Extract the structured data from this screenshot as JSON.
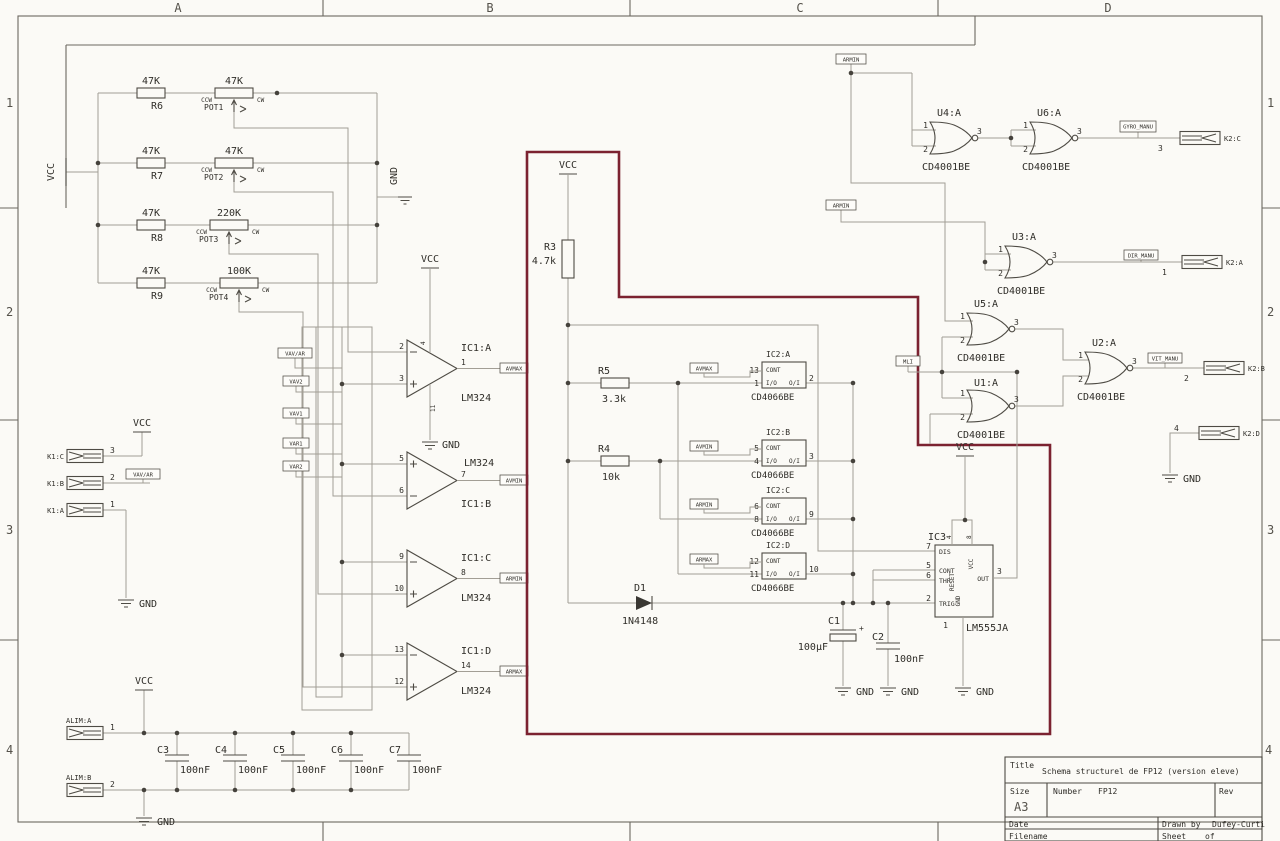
{
  "colors": {
    "highlight": "#7b2230"
  },
  "sheet": {
    "zones": [
      "A",
      "B",
      "C",
      "D"
    ],
    "rows": [
      "1",
      "2",
      "3",
      "4"
    ]
  },
  "common": {
    "vcc": "VCC",
    "gnd": "GND",
    "ccw": "CCW",
    "cw": "CW"
  },
  "resistor_network": {
    "rows": [
      {
        "ref": "R6",
        "value": "47K",
        "pot": "POT1",
        "pot_value": "47K"
      },
      {
        "ref": "R7",
        "value": "47K",
        "pot": "POT2",
        "pot_value": "47K"
      },
      {
        "ref": "R8",
        "value": "47K",
        "pot": "POT3",
        "pot_value": "220K"
      },
      {
        "ref": "R9",
        "value": "47K",
        "pot": "POT4",
        "pot_value": "100K"
      }
    ]
  },
  "input_labels": {
    "l1": "VAV/AR",
    "l2": "VAV2",
    "l3": "VAV1",
    "l4": "VAR1",
    "l5": "VAR2"
  },
  "opamps": [
    {
      "name": "IC1:A",
      "part": "LM324",
      "pin_inv": "2",
      "pin_ni": "3",
      "pin_out": "1",
      "out": "AVMAX",
      "pin_vcc": "4",
      "pin_gnd": "11"
    },
    {
      "name": "IC1:B",
      "part": "LM324",
      "pin_ni": "5",
      "pin_inv": "6",
      "pin_out": "7",
      "out": "AVMIN"
    },
    {
      "name": "IC1:C",
      "part": "LM324",
      "pin_inv": "9",
      "pin_ni": "10",
      "pin_out": "8",
      "out": "ARMIN"
    },
    {
      "name": "IC1:D",
      "part": "LM324",
      "pin_inv": "13",
      "pin_ni": "12",
      "pin_out": "14",
      "out": "ARMAX"
    }
  ],
  "analog_block": {
    "r3": {
      "ref": "R3",
      "value": "4.7k"
    },
    "r5": {
      "ref": "R5",
      "value": "3.3k"
    },
    "r4": {
      "ref": "R4",
      "value": "10k"
    },
    "d1": {
      "ref": "D1",
      "value": "1N4148"
    },
    "port_cont": "CONT",
    "port_io": "I/O",
    "port_oi": "O/I",
    "switches": [
      {
        "name": "IC2:A",
        "part": "CD4066BE",
        "pin_cont": "13",
        "pin_in": "1",
        "pin_out": "2",
        "ctrl": "AVMAX"
      },
      {
        "name": "IC2:B",
        "part": "CD4066BE",
        "pin_cont": "5",
        "pin_in": "4",
        "pin_out": "3",
        "ctrl": "AVMIN"
      },
      {
        "name": "IC2:C",
        "part": "CD4066BE",
        "pin_cont": "6",
        "pin_in": "8",
        "pin_out": "9",
        "ctrl": "ARMIN"
      },
      {
        "name": "IC2:D",
        "part": "CD4066BE",
        "pin_cont": "12",
        "pin_in": "11",
        "pin_out": "10",
        "ctrl": "ARMAX"
      }
    ],
    "c1": {
      "ref": "C1",
      "value": "100µF",
      "polarity": "+"
    },
    "c2": {
      "ref": "C2",
      "value": "100nF"
    },
    "timer": {
      "name": "IC3",
      "part": "LM555JA",
      "dis": "DIS",
      "cont": "CONT",
      "thr": "THR",
      "trig": "TRIG",
      "reset": "RESET",
      "vcc": "VCC",
      "out": "OUT",
      "gnd": "GND",
      "p_dis": "7",
      "p_cont": "5",
      "p_thr": "6",
      "p_trig": "2",
      "p_reset": "4",
      "p_vcc": "8",
      "p_out": "3",
      "p_gnd": "1"
    }
  },
  "gates": {
    "u4": {
      "name": "U4:A",
      "part": "CD4001BE",
      "p1": "1",
      "p2": "2",
      "p3": "3"
    },
    "u6": {
      "name": "U6:A",
      "part": "CD4001BE",
      "p1": "1",
      "p2": "2",
      "p3": "3"
    },
    "u3": {
      "name": "U3:A",
      "part": "CD4001BE",
      "p1": "1",
      "p2": "2",
      "p3": "3"
    },
    "u5": {
      "name": "U5:A",
      "part": "CD4001BE",
      "p1": "1",
      "p2": "2",
      "p3": "3"
    },
    "u1": {
      "name": "U1:A",
      "part": "CD4001BE",
      "p1": "1",
      "p2": "2",
      "p3": "3"
    },
    "u2": {
      "name": "U2:A",
      "part": "CD4001BE",
      "p1": "1",
      "p2": "2",
      "p3": "3"
    }
  },
  "net_labels": {
    "armin_a": "ARMIN",
    "armin_b": "ARMIN",
    "mli": "MLI",
    "gyro": "GYRO_MANU",
    "dir": "DIR_MANU",
    "vit": "VIT_MANU"
  },
  "connectors": {
    "k1c": {
      "name": "K1:C",
      "pin": "3"
    },
    "k1b": {
      "name": "K1:B",
      "pin": "2"
    },
    "k1a": {
      "name": "K1:A",
      "pin": "1"
    },
    "k1b_label": "VAV/AR",
    "k2c": {
      "name": "K2:C",
      "pin": "3"
    },
    "k2a": {
      "name": "K2:A",
      "pin": "1"
    },
    "k2b": {
      "name": "K2:B",
      "pin": "2"
    },
    "k2d": {
      "name": "K2:D",
      "pin": "4"
    },
    "alim_a": {
      "name": "ALIM:A",
      "pin": "1"
    },
    "alim_b": {
      "name": "ALIM:B",
      "pin": "2"
    }
  },
  "decoupling": [
    {
      "ref": "C3",
      "value": "100nF"
    },
    {
      "ref": "C4",
      "value": "100nF"
    },
    {
      "ref": "C5",
      "value": "100nF"
    },
    {
      "ref": "C6",
      "value": "100nF"
    },
    {
      "ref": "C7",
      "value": "100nF"
    }
  ],
  "title_block": {
    "title_label": "Title",
    "title": "Schema structurel de FP12 (version eleve)",
    "size_label": "Size",
    "size": "A3",
    "number_label": "Number",
    "number": "FP12",
    "rev_label": "Rev",
    "date_label": "Date",
    "drawn_label": "Drawn by",
    "drawn_by": "Dufey-Curti",
    "filename_label": "Filename",
    "sheet_label": "Sheet",
    "of_label": "of"
  }
}
